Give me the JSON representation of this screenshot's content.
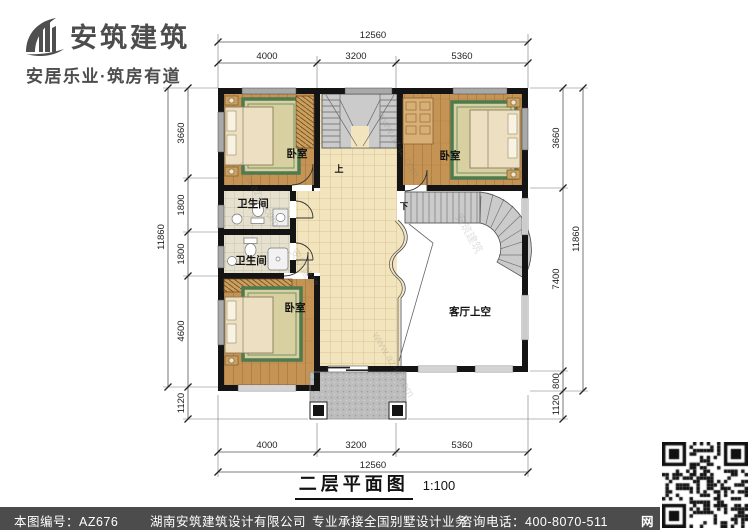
{
  "logo": {
    "company": "安筑建筑",
    "tagline": "安居乐业·筑房有道"
  },
  "plan": {
    "title": "二层平面图",
    "scale": "1:100",
    "labels": {
      "bedroom_tl": "卧室",
      "bedroom_tr": "卧室",
      "bedroom_bl": "卧室",
      "bath1": "卫生间",
      "bath2": "卫生间",
      "living_void": "客厅上空",
      "stair_up": "上",
      "stair_down": "下"
    },
    "dims": {
      "top": {
        "total": "12560",
        "segments": [
          "4000",
          "3200",
          "5360"
        ]
      },
      "bottom": {
        "total": "12560",
        "segments": [
          "4000",
          "3200",
          "5360"
        ]
      },
      "left": {
        "total": "11860",
        "segments": [
          "3660",
          "1800",
          "1800",
          "4600",
          "1120"
        ]
      },
      "right": {
        "total": "11860",
        "segments": [
          "3660",
          "7400",
          "800",
          "1120"
        ]
      }
    }
  },
  "footer": {
    "sheet_label": "本图编号：AZ676",
    "company": "湖南安筑建筑设计有限公司",
    "service": "专业承接全国别墅设计业务",
    "phone": "咨询电话：400-8070-511",
    "badge": "网"
  },
  "watermark": {
    "latin": "www.az-jz.com",
    "cn": "安筑建筑"
  },
  "colors": {
    "wall": "#141414",
    "wood": "#c59455",
    "tile": "#f2e4bd",
    "footer_bar": "#4c4c4c",
    "rug_border": "#4d7a4f"
  }
}
